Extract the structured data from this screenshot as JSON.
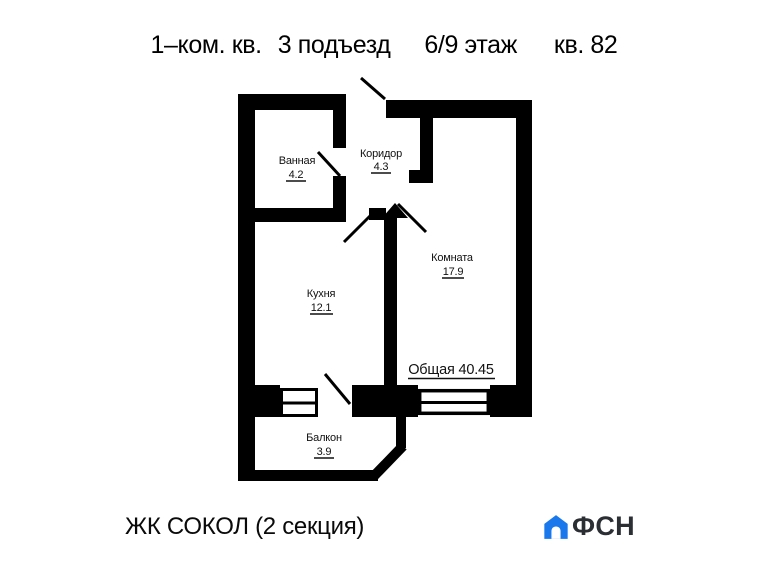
{
  "title": {
    "segments": [
      "1–ком. кв.",
      "3 подъезд",
      "6/9 этаж",
      "кв. 82"
    ]
  },
  "rooms": {
    "bathroom": {
      "name": "Ванная",
      "area": "4.2"
    },
    "corridor": {
      "name": "Коридор",
      "area": "4.3"
    },
    "living": {
      "name": "Комната",
      "area": "17.9"
    },
    "kitchen": {
      "name": "Кухня",
      "area": "12.1"
    },
    "balcony": {
      "name": "Балкон",
      "area": "3.9"
    }
  },
  "total": "Общая 40.45",
  "footer": {
    "project": "ЖК СОКОЛ (2 секция)",
    "logo": {
      "text": "ФСН",
      "icon": "house-icon",
      "color": "#1878ec",
      "text_color": "#2b2e33"
    }
  },
  "colors": {
    "ink": "#000000",
    "background": "#ffffff"
  }
}
